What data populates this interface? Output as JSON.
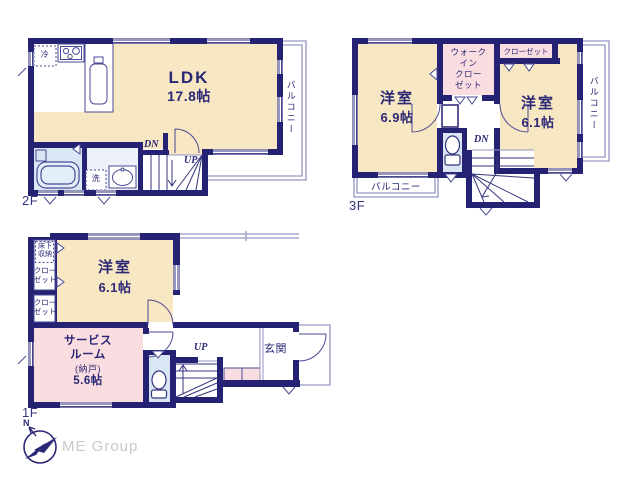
{
  "colors": {
    "wall_navy": "#262273",
    "room_cream": "#f8e7c3",
    "room_pink": "#fadde0",
    "wet_area_blue": "#d9e6f4",
    "washroom_blue": "#ecf1fa",
    "thin_line": "#9396c4",
    "label_navy": "#2b2875",
    "logo_gray": "#c9c9c9"
  },
  "floor2": {
    "floor_label": "2F",
    "ldk_name": "LDK",
    "ldk_size": "17.8帖",
    "balcony": "バルコニー",
    "fridge": "冷",
    "laundry": "洗",
    "stairs_down": "DN",
    "stairs_up": "UP"
  },
  "floor3": {
    "floor_label": "3F",
    "bedroom_left_name": "洋室",
    "bedroom_left_size": "6.9帖",
    "bedroom_right_name": "洋室",
    "bedroom_right_size": "6.1帖",
    "walk_in_closet": "ウォーク\nイン\nクロー\nゼット",
    "closet": "クローゼット",
    "balcony_right": "バルコニー",
    "balcony_bottom": "バルコニー",
    "stairs_down": "DN"
  },
  "floor1": {
    "floor_label": "1F",
    "bedroom_name": "洋室",
    "bedroom_size": "6.1帖",
    "underfloor_storage": "床下\n収納",
    "closet_upper": "クロー\nゼット",
    "closet_lower": "クロー\nゼット",
    "service_room_name": "サービス\nルーム",
    "service_room_sub": "(納戸)",
    "service_room_size": "5.6帖",
    "entrance": "玄関",
    "stairs_up": "UP"
  },
  "footer": {
    "company": "ME Group",
    "north_label": "N"
  }
}
